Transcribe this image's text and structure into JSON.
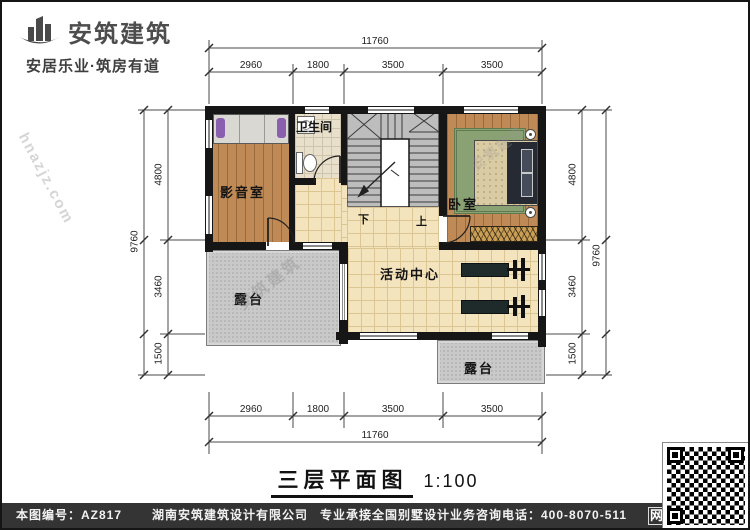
{
  "brand": {
    "name": "安筑建筑",
    "tagline": "安居乐业·筑房有道"
  },
  "plan": {
    "rooms": {
      "media": "影音室",
      "bath": "卫生间",
      "bedroom": "卧室",
      "activity": "活动中心",
      "terrace": "露台",
      "stair_down": "下",
      "stair_up": "上"
    },
    "dims": {
      "h_total": "11760",
      "h_segments": [
        "2960",
        "1800",
        "3500",
        "3500"
      ],
      "v_total": "9760",
      "v_segments": [
        "4800",
        "3460",
        "1500"
      ]
    }
  },
  "titleblock": {
    "title": "三层平面图",
    "scale": "1:100"
  },
  "footer": {
    "drawing_no": "本图编号：AZ817",
    "company": "湖南安筑建筑设计有限公司",
    "service": "专业承接全国别墅设计业务",
    "phone": "咨询电话：400-8070-511",
    "web": "网"
  },
  "watermarks": {
    "site": "hnazjz.com",
    "brand": "安筑建筑"
  },
  "colors": {
    "wall": "#161616",
    "wood_floor": "#bf8a55",
    "hall_tile": "#f4e4bd",
    "terrace": "#c9c9c9",
    "rug": "#8aa173",
    "footer_bg": "#343434"
  }
}
